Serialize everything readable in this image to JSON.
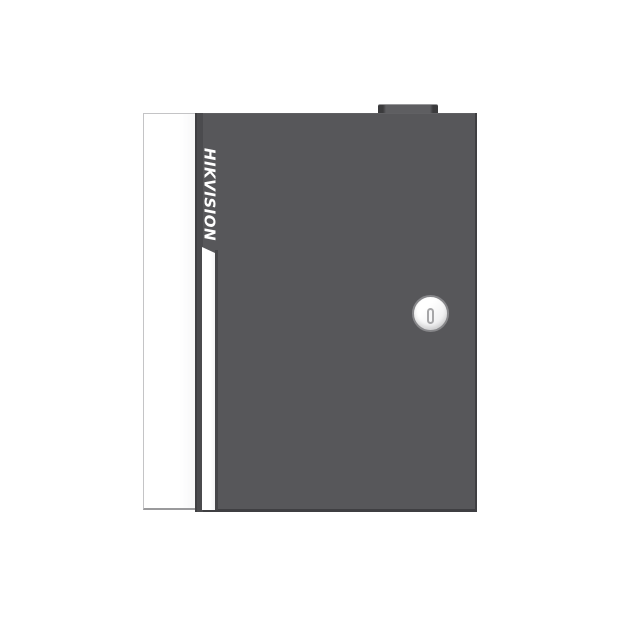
{
  "device": {
    "brand_label": "HIKVISION",
    "description": "access controller enclosure product photo",
    "colors": {
      "background": "#FFFFFF",
      "side_panel": "#F7F7F8",
      "side_panel_border": "#C4C4C6",
      "side_panel_bottom": "#9A9A9C",
      "door": "#57575A",
      "door_edge": "#3F3F42",
      "door_left_shade": "#4B4B4E",
      "stripe": "#F4F4F5",
      "stripe_shadow": "#464649",
      "tab": "#5E5E61",
      "tab_end": "#3B3B3D",
      "tab_highlight": "#98989A",
      "lock_rim": "#87878A",
      "lock_face_light": "#FFFFFF",
      "lock_face_dark": "#E6E6E8",
      "keyhole_outline": "#A6A6A8",
      "keyhole_fill": "#F7F7F8",
      "logo": "#FFFFFF"
    }
  }
}
